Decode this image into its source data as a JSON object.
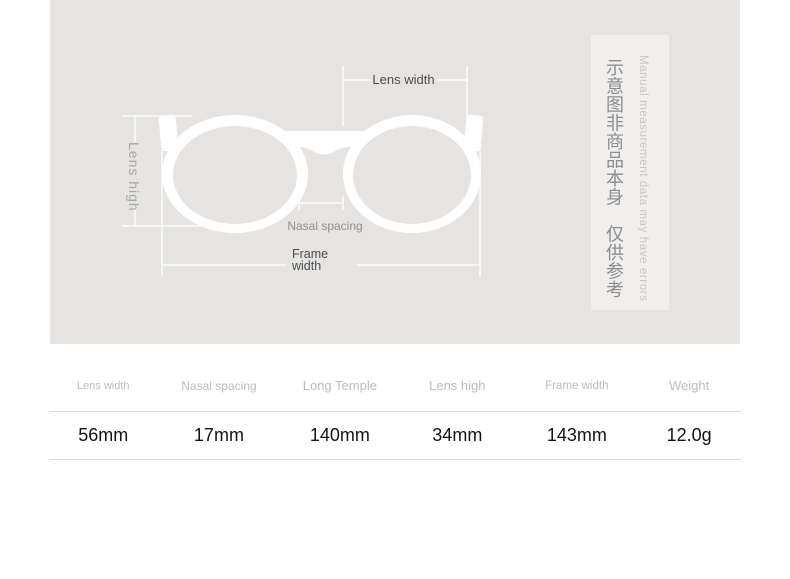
{
  "colors": {
    "page_bg": "#ffffff",
    "canvas_bg": "#e5e4e3",
    "notice_bg": "#f0efee",
    "glasses_fill": "#ffffff",
    "measure_line": "#fcfcfc",
    "dark_label": "#4d4d4d",
    "muted_label": "#8f8f8f",
    "table_header": "#bcbcbc",
    "table_value": "#141414"
  },
  "diagram": {
    "labels": {
      "lens_width": "Lens width",
      "lens_high": "Lens high",
      "nasal_spacing": "Nasal spacing",
      "frame_width": "Frame\nwidth"
    }
  },
  "notice_panel": {
    "chinese_text": "示意图非商品本身　仅供参考",
    "english_text": "Manual measurement data may have errors"
  },
  "spec_table": {
    "columns": [
      {
        "label": "Lens width",
        "value": "56mm"
      },
      {
        "label": "Nasal spacing",
        "value": "17mm"
      },
      {
        "label": "Long Temple",
        "value": "140mm"
      },
      {
        "label": "Lens high",
        "value": "34mm"
      },
      {
        "label": "Frame width",
        "value": "143mm"
      },
      {
        "label": "Weight",
        "value": "12.0g"
      }
    ]
  }
}
